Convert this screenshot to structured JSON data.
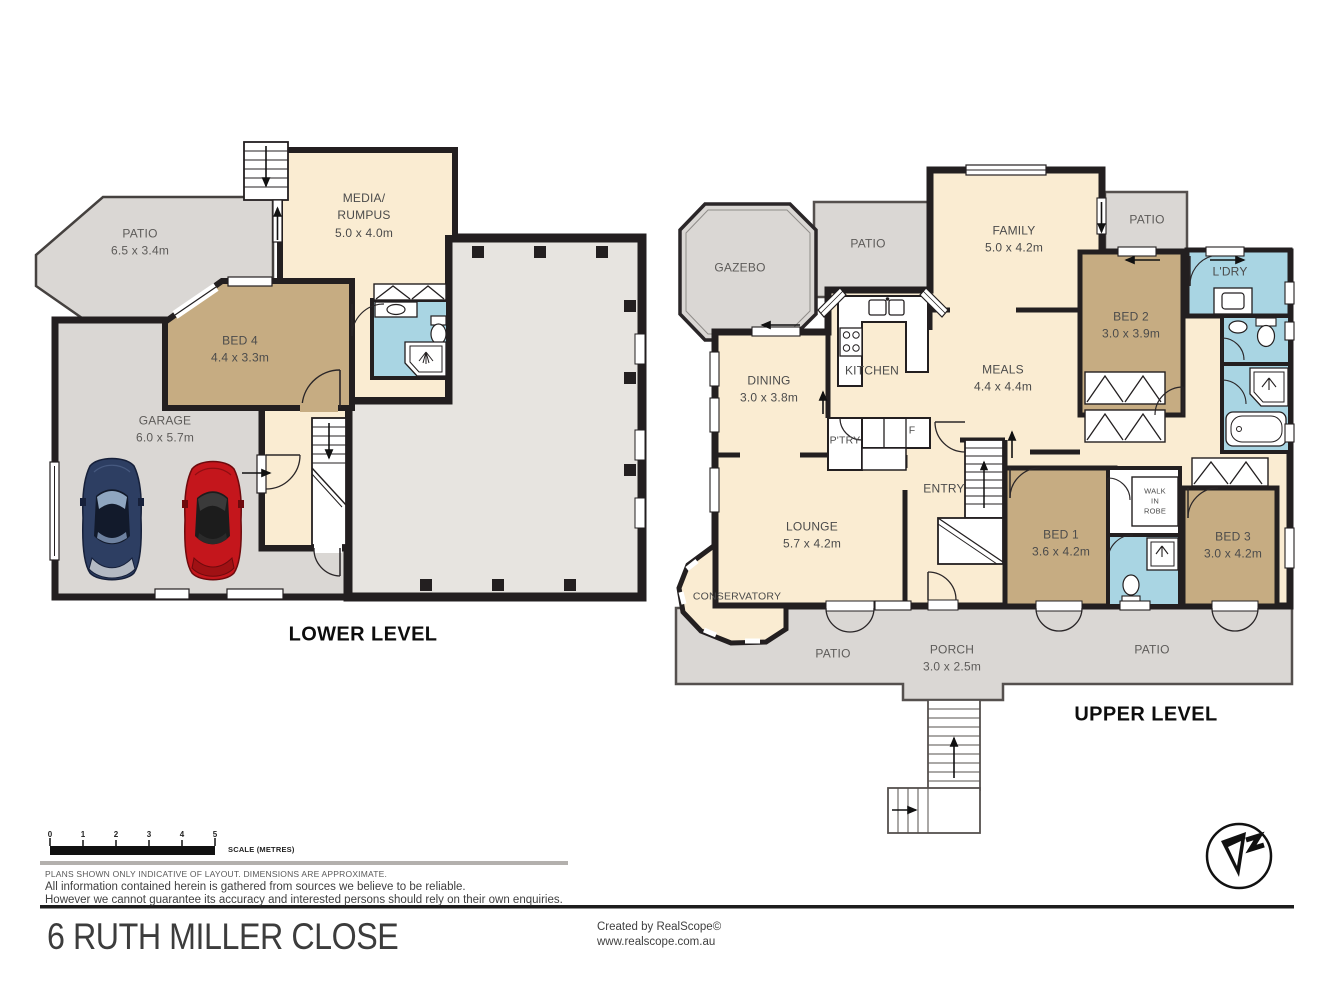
{
  "lower": {
    "title": "LOWER LEVEL",
    "patio": {
      "label": "PATIO",
      "dims": "6.5 x 3.4m"
    },
    "media": {
      "label1": "MEDIA/",
      "label2": "RUMPUS",
      "dims": "5.0 x 4.0m"
    },
    "bed4": {
      "label": "BED 4",
      "dims": "4.4 x 3.3m"
    },
    "garage": {
      "label": "GARAGE",
      "dims": "6.0 x 5.7m"
    }
  },
  "upper": {
    "title": "UPPER LEVEL",
    "gazebo": {
      "label": "GAZEBO"
    },
    "patio_top": {
      "label": "PATIO"
    },
    "family": {
      "label": "FAMILY",
      "dims": "5.0 x 4.2m"
    },
    "patio_ne": {
      "label": "PATIO"
    },
    "laundry": {
      "label": "L'DRY"
    },
    "bed2": {
      "label": "BED 2",
      "dims": "3.0 x 3.9m"
    },
    "dining": {
      "label": "DINING",
      "dims": "3.0 x 3.8m"
    },
    "kitchen": {
      "label": "KITCHEN"
    },
    "meals": {
      "label": "MEALS",
      "dims": "4.4 x 4.4m"
    },
    "pantry": {
      "label": "P'TRY"
    },
    "fridge": {
      "label": "F"
    },
    "entry": {
      "label": "ENTRY"
    },
    "lounge": {
      "label": "LOUNGE",
      "dims": "5.7 x 4.2m"
    },
    "conservatory": {
      "label": "CONSERVATORY"
    },
    "bed1": {
      "label": "BED 1",
      "dims": "3.6 x 4.2m"
    },
    "walk_in_robe": {
      "l1": "WALK",
      "l2": "IN",
      "l3": "ROBE"
    },
    "bed3": {
      "label": "BED 3",
      "dims": "3.0 x 4.2m"
    },
    "patio_sw": {
      "label": "PATIO"
    },
    "porch": {
      "label": "PORCH",
      "dims": "3.0 x 2.5m"
    },
    "patio_se": {
      "label": "PATIO"
    }
  },
  "scale_bar": {
    "ticks": [
      "0",
      "1",
      "2",
      "3",
      "4",
      "5"
    ],
    "caption": "SCALE (METRES)"
  },
  "notes": {
    "plans": "PLANS SHOWN ONLY INDICATIVE OF LAYOUT.  DIMENSIONS ARE APPROXIMATE.",
    "disclaimer1": "All information contained herein is gathered from sources we believe to be reliable.",
    "disclaimer2": "However we cannot guarantee its accuracy and interested persons should rely on their own enquiries."
  },
  "footer": {
    "address": "6 RUTH MILLER CLOSE",
    "created_by": "Created by RealScope©",
    "website": "www.realscope.com.au"
  },
  "palette": {
    "room_cream": "#faecd2",
    "bedroom_tan": "#c6ac82",
    "wet_area_blue": "#a9d5e3",
    "patio_grey": "#dad7d4",
    "underfloor_grey": "#e7e4e0",
    "wall_black": "#231f20"
  }
}
